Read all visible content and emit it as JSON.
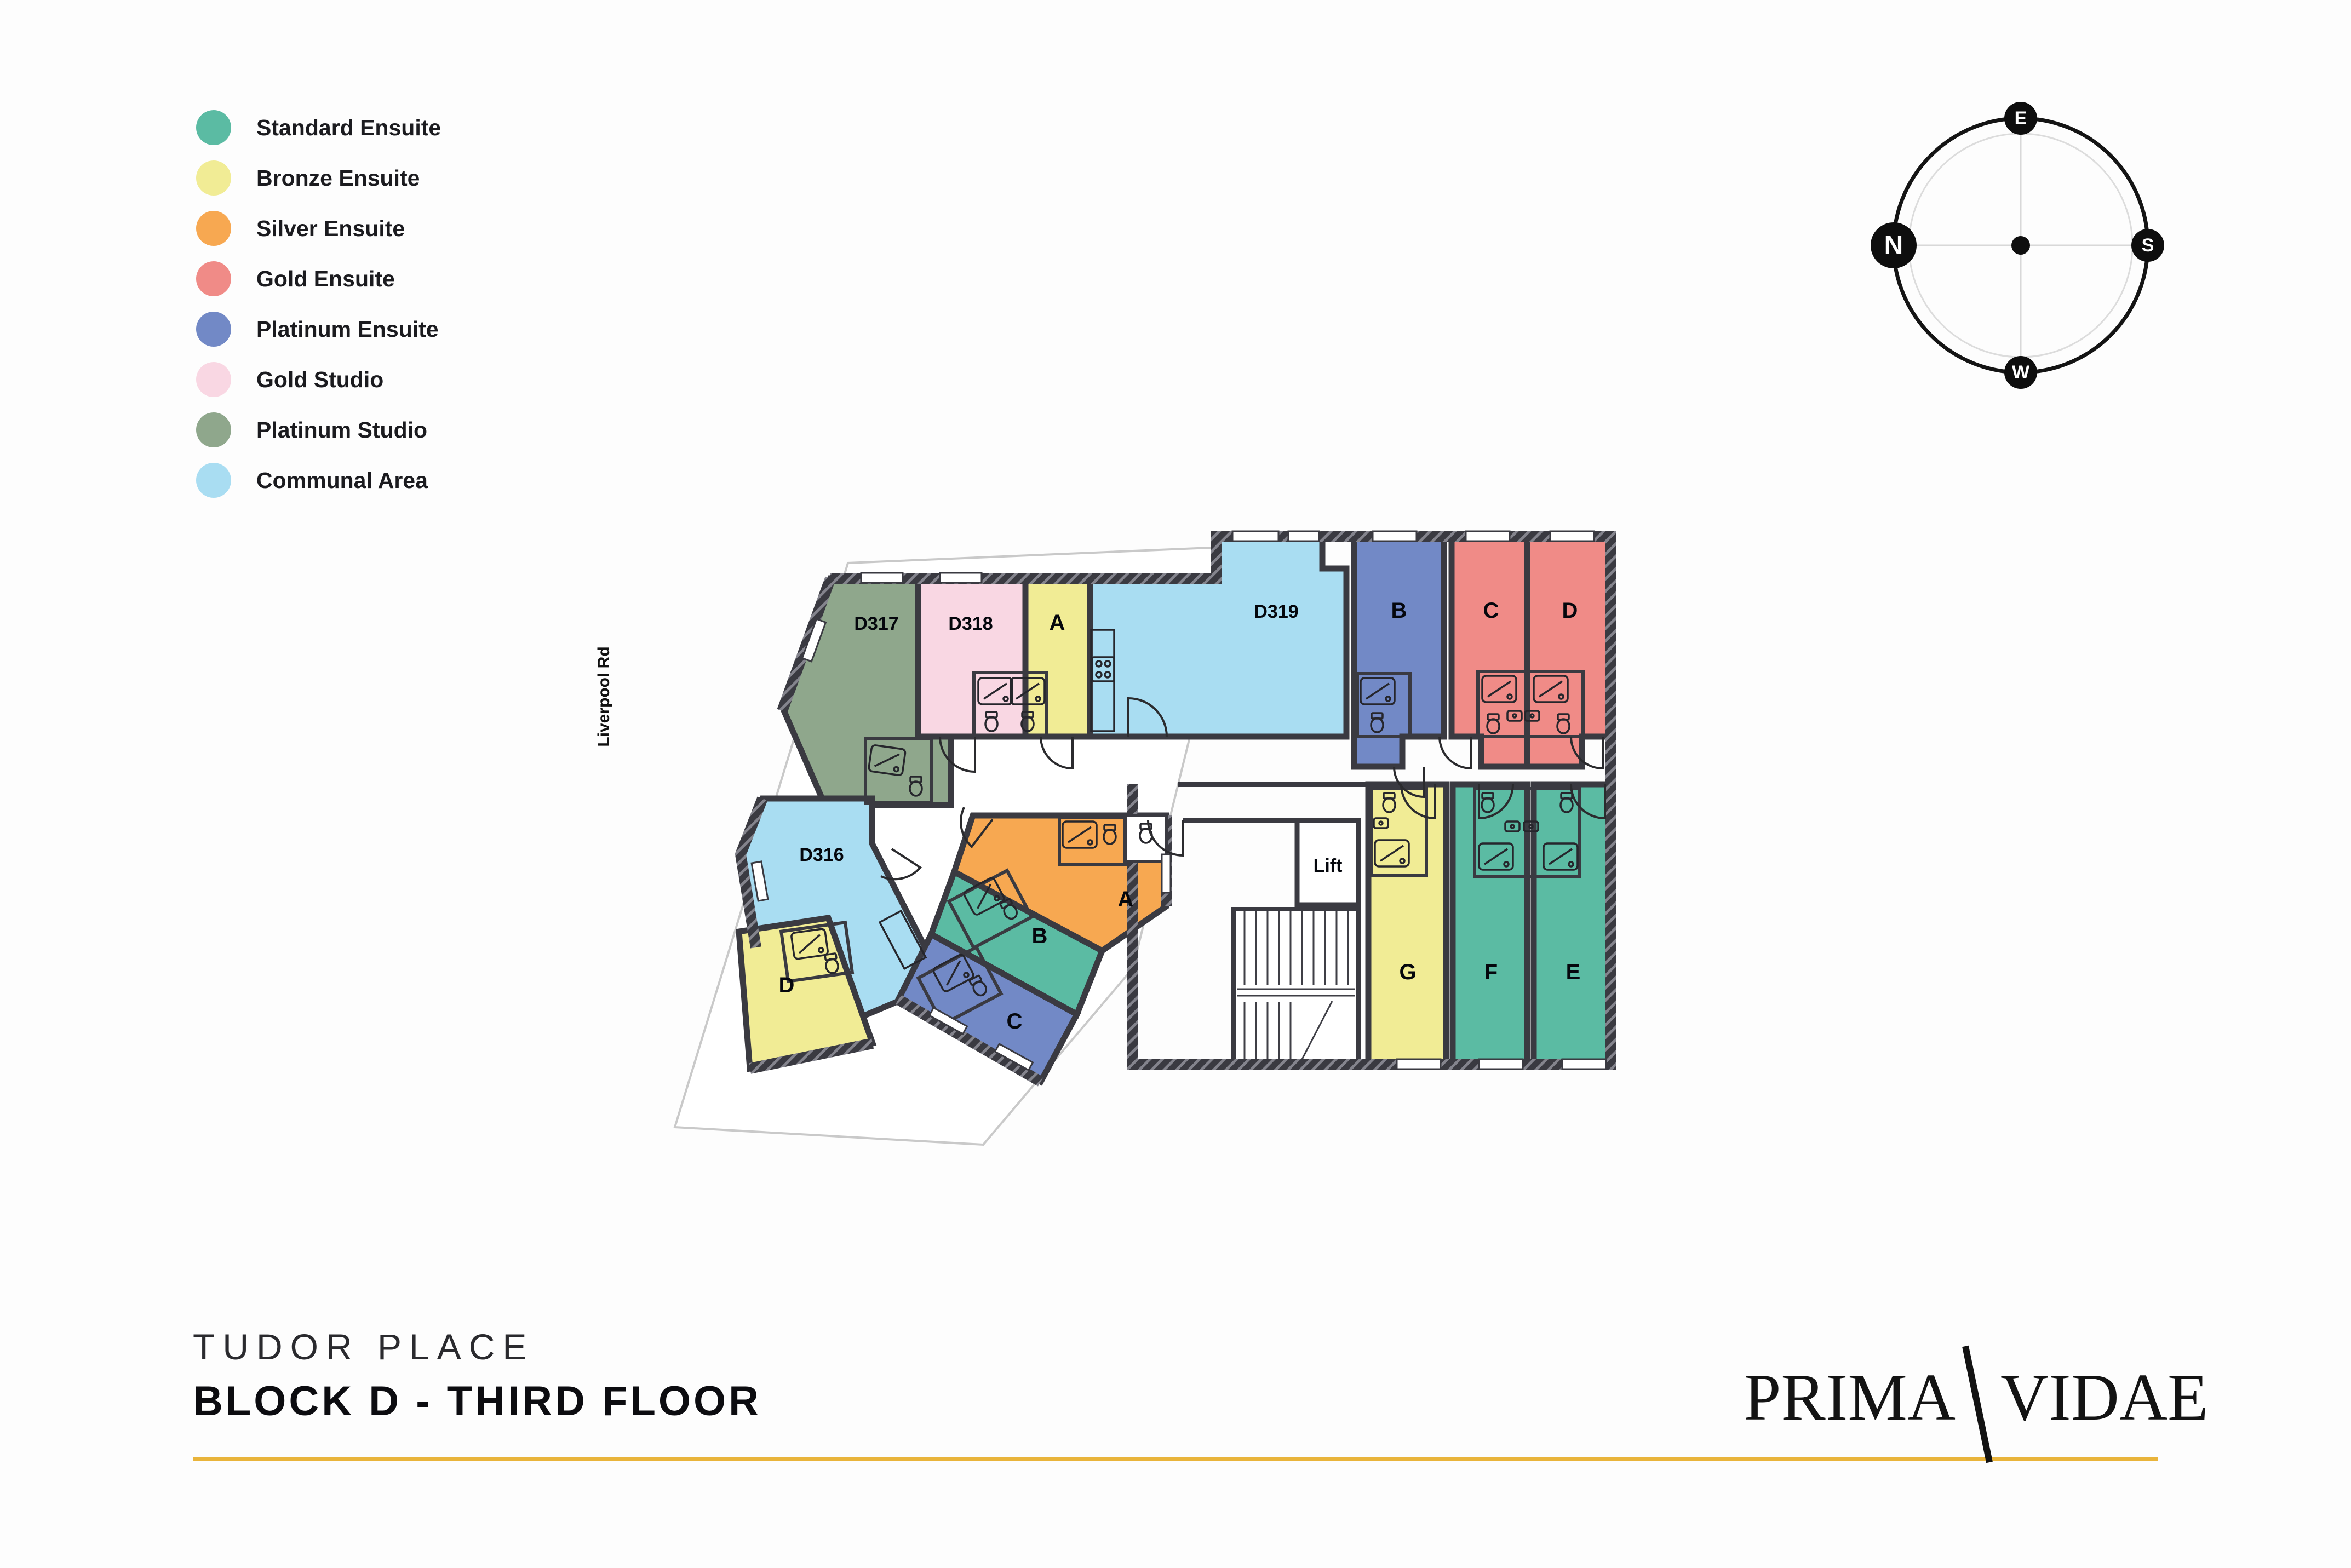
{
  "colors": {
    "standard_ensuite": "#5BBBA3",
    "bronze_ensuite": "#F1EC95",
    "silver_ensuite": "#F7A851",
    "gold_ensuite": "#F08B87",
    "platinum_ensuite": "#7289C6",
    "gold_studio": "#F9D7E3",
    "platinum_studio": "#8FA78C",
    "communal_area": "#A9DDF2",
    "wall": "#3A3A41",
    "accent": "#E9B43B"
  },
  "legend": {
    "items": [
      {
        "label": "Standard Ensuite"
      },
      {
        "label": "Bronze Ensuite"
      },
      {
        "label": "Silver Ensuite"
      },
      {
        "label": "Gold Ensuite"
      },
      {
        "label": "Platinum Ensuite"
      },
      {
        "label": "Gold Studio"
      },
      {
        "label": "Platinum Studio"
      },
      {
        "label": "Communal Area"
      }
    ]
  },
  "compass": {
    "east": "E",
    "north": "N",
    "south": "S",
    "west": "W"
  },
  "plan": {
    "street_label": "Liverpool Rd",
    "lift_label": "Lift",
    "rooms": [
      {
        "label": "D317",
        "type": "Platinum Studio"
      },
      {
        "label": "D318",
        "type": "Gold Studio"
      },
      {
        "label": "A",
        "type": "Bronze Ensuite"
      },
      {
        "label": "D319",
        "type": "Communal Area"
      },
      {
        "label": "B",
        "type": "Platinum Ensuite"
      },
      {
        "label": "C",
        "type": "Gold Ensuite"
      },
      {
        "label": "D",
        "type": "Gold Ensuite"
      },
      {
        "label": "D316",
        "type": "Communal Area"
      },
      {
        "label": "D",
        "type": "Bronze Ensuite"
      },
      {
        "label": "A",
        "type": "Silver Ensuite"
      },
      {
        "label": "B",
        "type": "Standard Ensuite"
      },
      {
        "label": "C",
        "type": "Platinum Ensuite"
      },
      {
        "label": "G",
        "type": "Bronze Ensuite"
      },
      {
        "label": "F",
        "type": "Standard Ensuite"
      },
      {
        "label": "E",
        "type": "Standard Ensuite"
      }
    ]
  },
  "footer": {
    "development": "TUDOR PLACE",
    "title": "BLOCK D - THIRD FLOOR"
  },
  "brand": {
    "word1": "PRIMA",
    "word2": "VIDAE"
  }
}
